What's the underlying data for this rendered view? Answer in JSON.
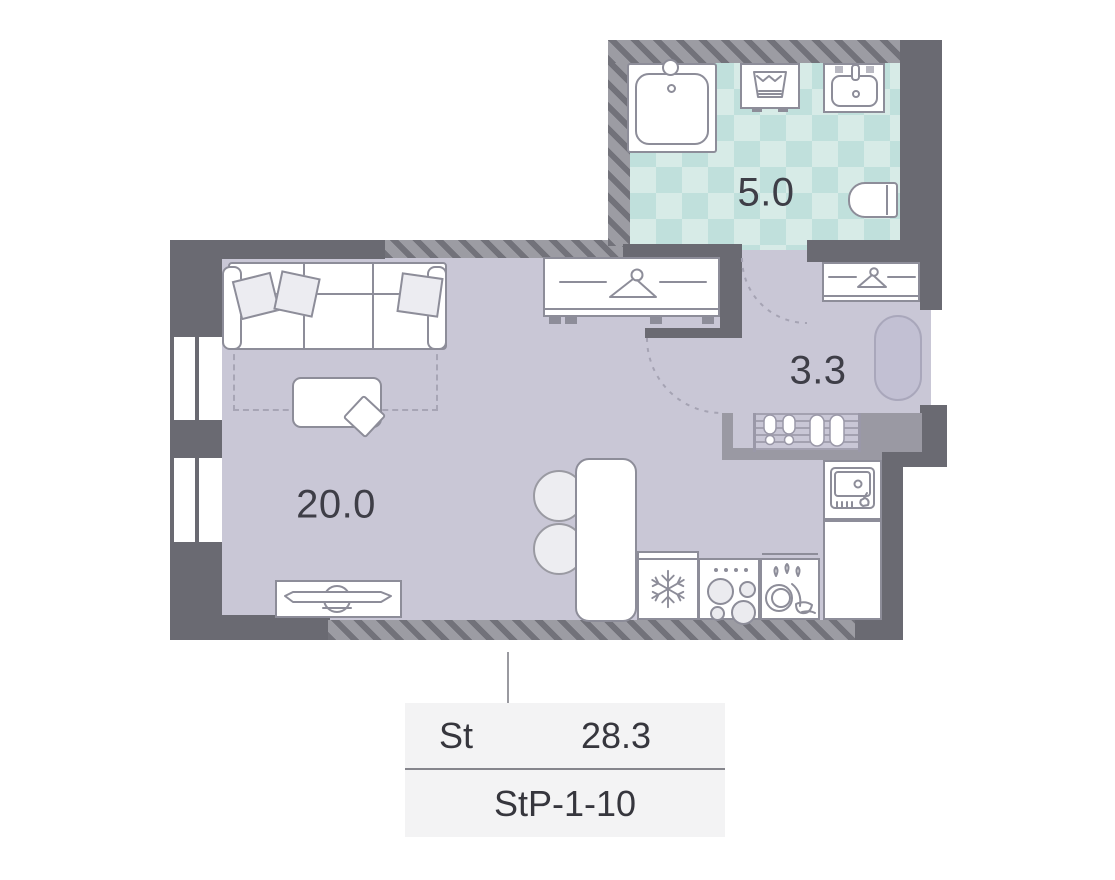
{
  "plan_title": "Studio apartment floor plan",
  "rooms": {
    "living": {
      "name": "living-kitchen",
      "area": "20.0"
    },
    "bathroom": {
      "name": "bathroom",
      "area": "5.0"
    },
    "hallway": {
      "name": "hallway",
      "area": "3.3"
    }
  },
  "legend": {
    "type": "St",
    "area": "28.3",
    "unit": "StP-1-10"
  },
  "colors": {
    "wall_dark": "#6a6a72",
    "wall_medium": "#9a99a3",
    "wall_hatch_base": "#9c9ca3",
    "wall_hatch_stripe": "#72727a",
    "floor_living": "#c9c7d6",
    "tile_light": "#d7ebe7",
    "tile_dark": "#c0e0dc",
    "furniture_outline": "#8d8d99",
    "text": "#3e3e47",
    "legend_bg": "#f3f3f4",
    "rug_oval": "#c2c0d3",
    "door_arc": "#a5a3b3"
  },
  "icons": [
    "hanger-icon",
    "shower-icon",
    "washing-machine-icon",
    "bath-sink-icon",
    "toilet-icon",
    "snowflake-icon",
    "stove-icon",
    "dishwasher-icon",
    "kitchen-sink-icon",
    "tv-icon",
    "shoe-mat-icon",
    "sofa",
    "coffee-table",
    "dining-table",
    "stool",
    "window",
    "door-arc"
  ]
}
